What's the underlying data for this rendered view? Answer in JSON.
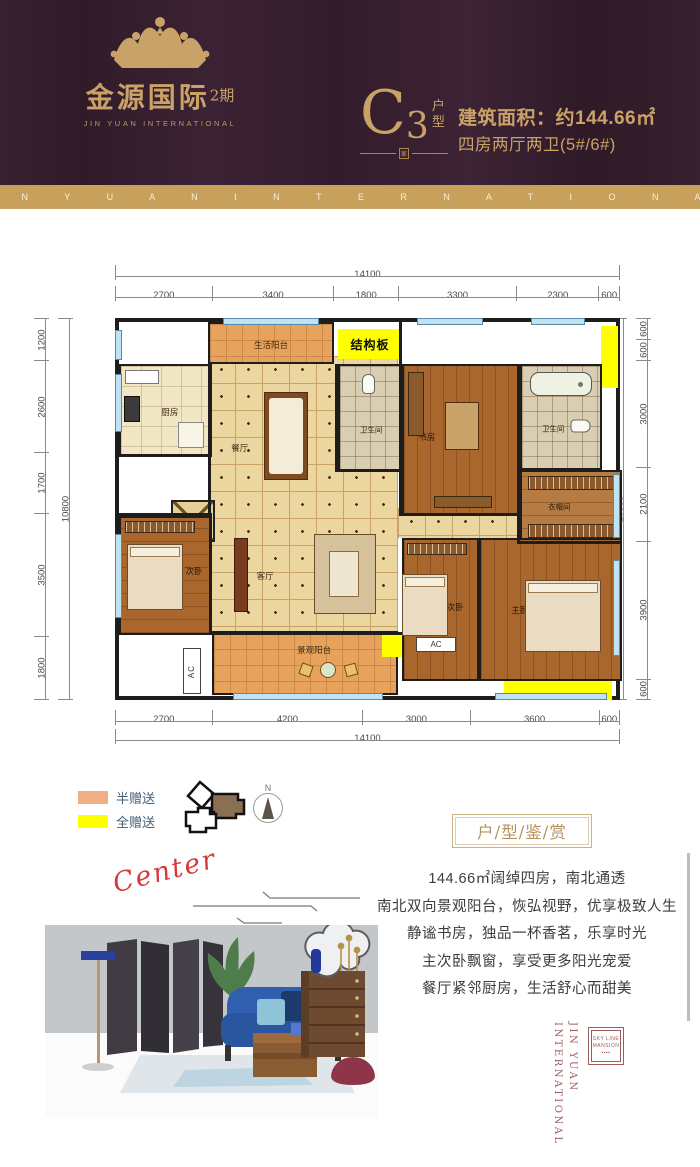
{
  "header": {
    "logo": {
      "crown_icon": "crown-icon",
      "brand_cn": "金源国际",
      "brand_phase": "2期",
      "brand_en": "JIN YUAN INTERNATIONAL"
    },
    "unit": {
      "letter": "C",
      "number": "3",
      "hu": "户",
      "xing": "型",
      "jia": "家"
    },
    "area_line": "建筑面积：约144.66㎡",
    "layout_line": "四房两厅两卫(5#/6#)"
  },
  "band": {
    "text": "J I N Y U A N I N T E R N A T I O N A L"
  },
  "plan": {
    "dims_top_total": "14100",
    "dims_top": [
      "2700",
      "3400",
      "1800",
      "3300",
      "2300",
      "600"
    ],
    "dims_bottom": [
      "2700",
      "4200",
      "3000",
      "3600",
      "600"
    ],
    "dims_bottom_total": "14100",
    "dims_left": [
      "1200",
      "2600",
      "1700",
      "3500",
      "1800"
    ],
    "dims_left_total": "10800",
    "dims_right": [
      "600",
      "600",
      "3000",
      "2100",
      "3900",
      "600"
    ],
    "dims_right_total": "10800",
    "structure_label": "结构板",
    "rooms": {
      "life_balcony": "生活阳台",
      "kitchen": "厨房",
      "dining": "餐厅",
      "guest_bath": "卫生间",
      "study": "书房",
      "master_bath": "卫生间",
      "entry": "玄关",
      "cloakroom": "衣帽间",
      "bedroom2": "次卧",
      "living": "客厅",
      "bedroom3": "次卧",
      "master": "主卧",
      "view_balcony": "景观阳台",
      "ac_left": "AC",
      "ac_right": "AC"
    }
  },
  "legend": {
    "half_gift": {
      "label": "半赠送",
      "color": "#f0b083"
    },
    "full_gift": {
      "label": "全赠送",
      "color": "#ffff00"
    },
    "compass_n": "N"
  },
  "appreciation": {
    "title": "户/型/鉴/赏",
    "lines": [
      "144.66㎡阔绰四房，南北通透",
      "南北双向景观阳台，恢弘视野，优享极致人生",
      "静谧书房，独品一杯香茗，乐享时光",
      "主次卧飘窗，享受更多阳光宠爱",
      "餐厅紧邻厨房，生活舒心而甜美"
    ]
  },
  "scene": {
    "script": "Center"
  },
  "footer_brand": {
    "line1": "JIN YUAN",
    "line2": "INTERNATIONAL",
    "stamp_line1": "SKY LINE",
    "stamp_line2": "MANSION",
    "stamp_dots": "▪▪▪▪"
  },
  "colors": {
    "header_bg": "#38202f",
    "gold": "#c9a268",
    "band": "#c7a15c",
    "yellow_zone": "#ffff00",
    "balcony_orange": "#e7a25c",
    "accent_red": "#d43a3c",
    "brand_maroon": "#9b5c63"
  }
}
